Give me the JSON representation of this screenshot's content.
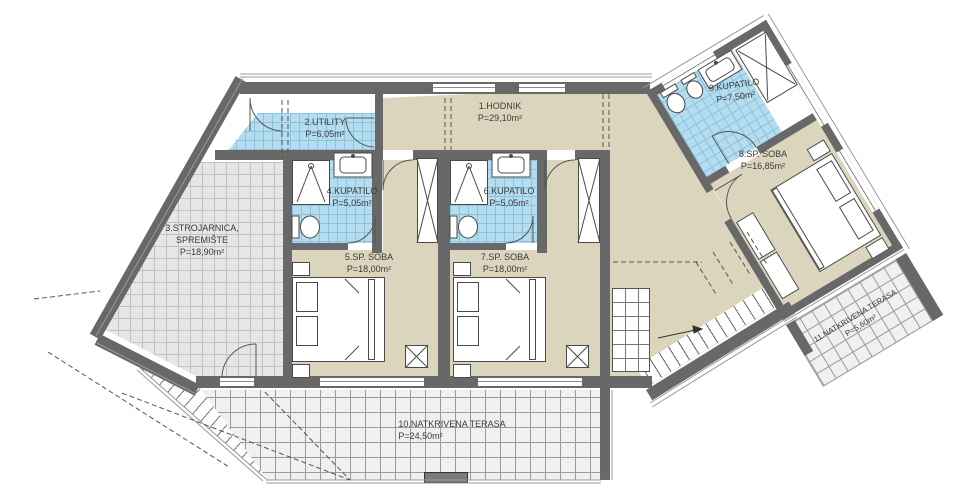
{
  "rooms": {
    "hodnik": {
      "name": "1.HODNIK",
      "area": "P=29,10m²"
    },
    "utility": {
      "name": "2.UTILITY",
      "area": "P=6,05m²"
    },
    "strojarnica": {
      "name": "3.STROJARNICA,",
      "name2": "SPREMIŠTE",
      "area": "P=18,90m²"
    },
    "kupatilo4": {
      "name": "4.KUPATILO",
      "area": "P=5,05m²"
    },
    "soba5": {
      "name": "5.SP. SOBA",
      "area": "P=18,00m²"
    },
    "kupatilo6": {
      "name": "6.KUPATILO",
      "area": "P=5,05m²"
    },
    "soba7": {
      "name": "7.SP. SOBA",
      "area": "P=18,00m²"
    },
    "soba8": {
      "name": "8.SP. SOBA",
      "area": "P=16,85m²"
    },
    "kupatilo9": {
      "name": "9.KUPATILO",
      "area": "P=7,50m²"
    },
    "terasa10": {
      "name": "10.NATKRIVENA TERASA",
      "area": "P=24,50m²"
    },
    "terasa11": {
      "name": "11.NATKRIVENA TERASA",
      "area": "P=5,60m²"
    }
  },
  "colors": {
    "wall": "#686868",
    "bathroom_tile": "#b5ddf0",
    "floor": "#dcd5bd",
    "storage_tile": "#e6e6e6",
    "terrace": "#f0f0ee"
  }
}
